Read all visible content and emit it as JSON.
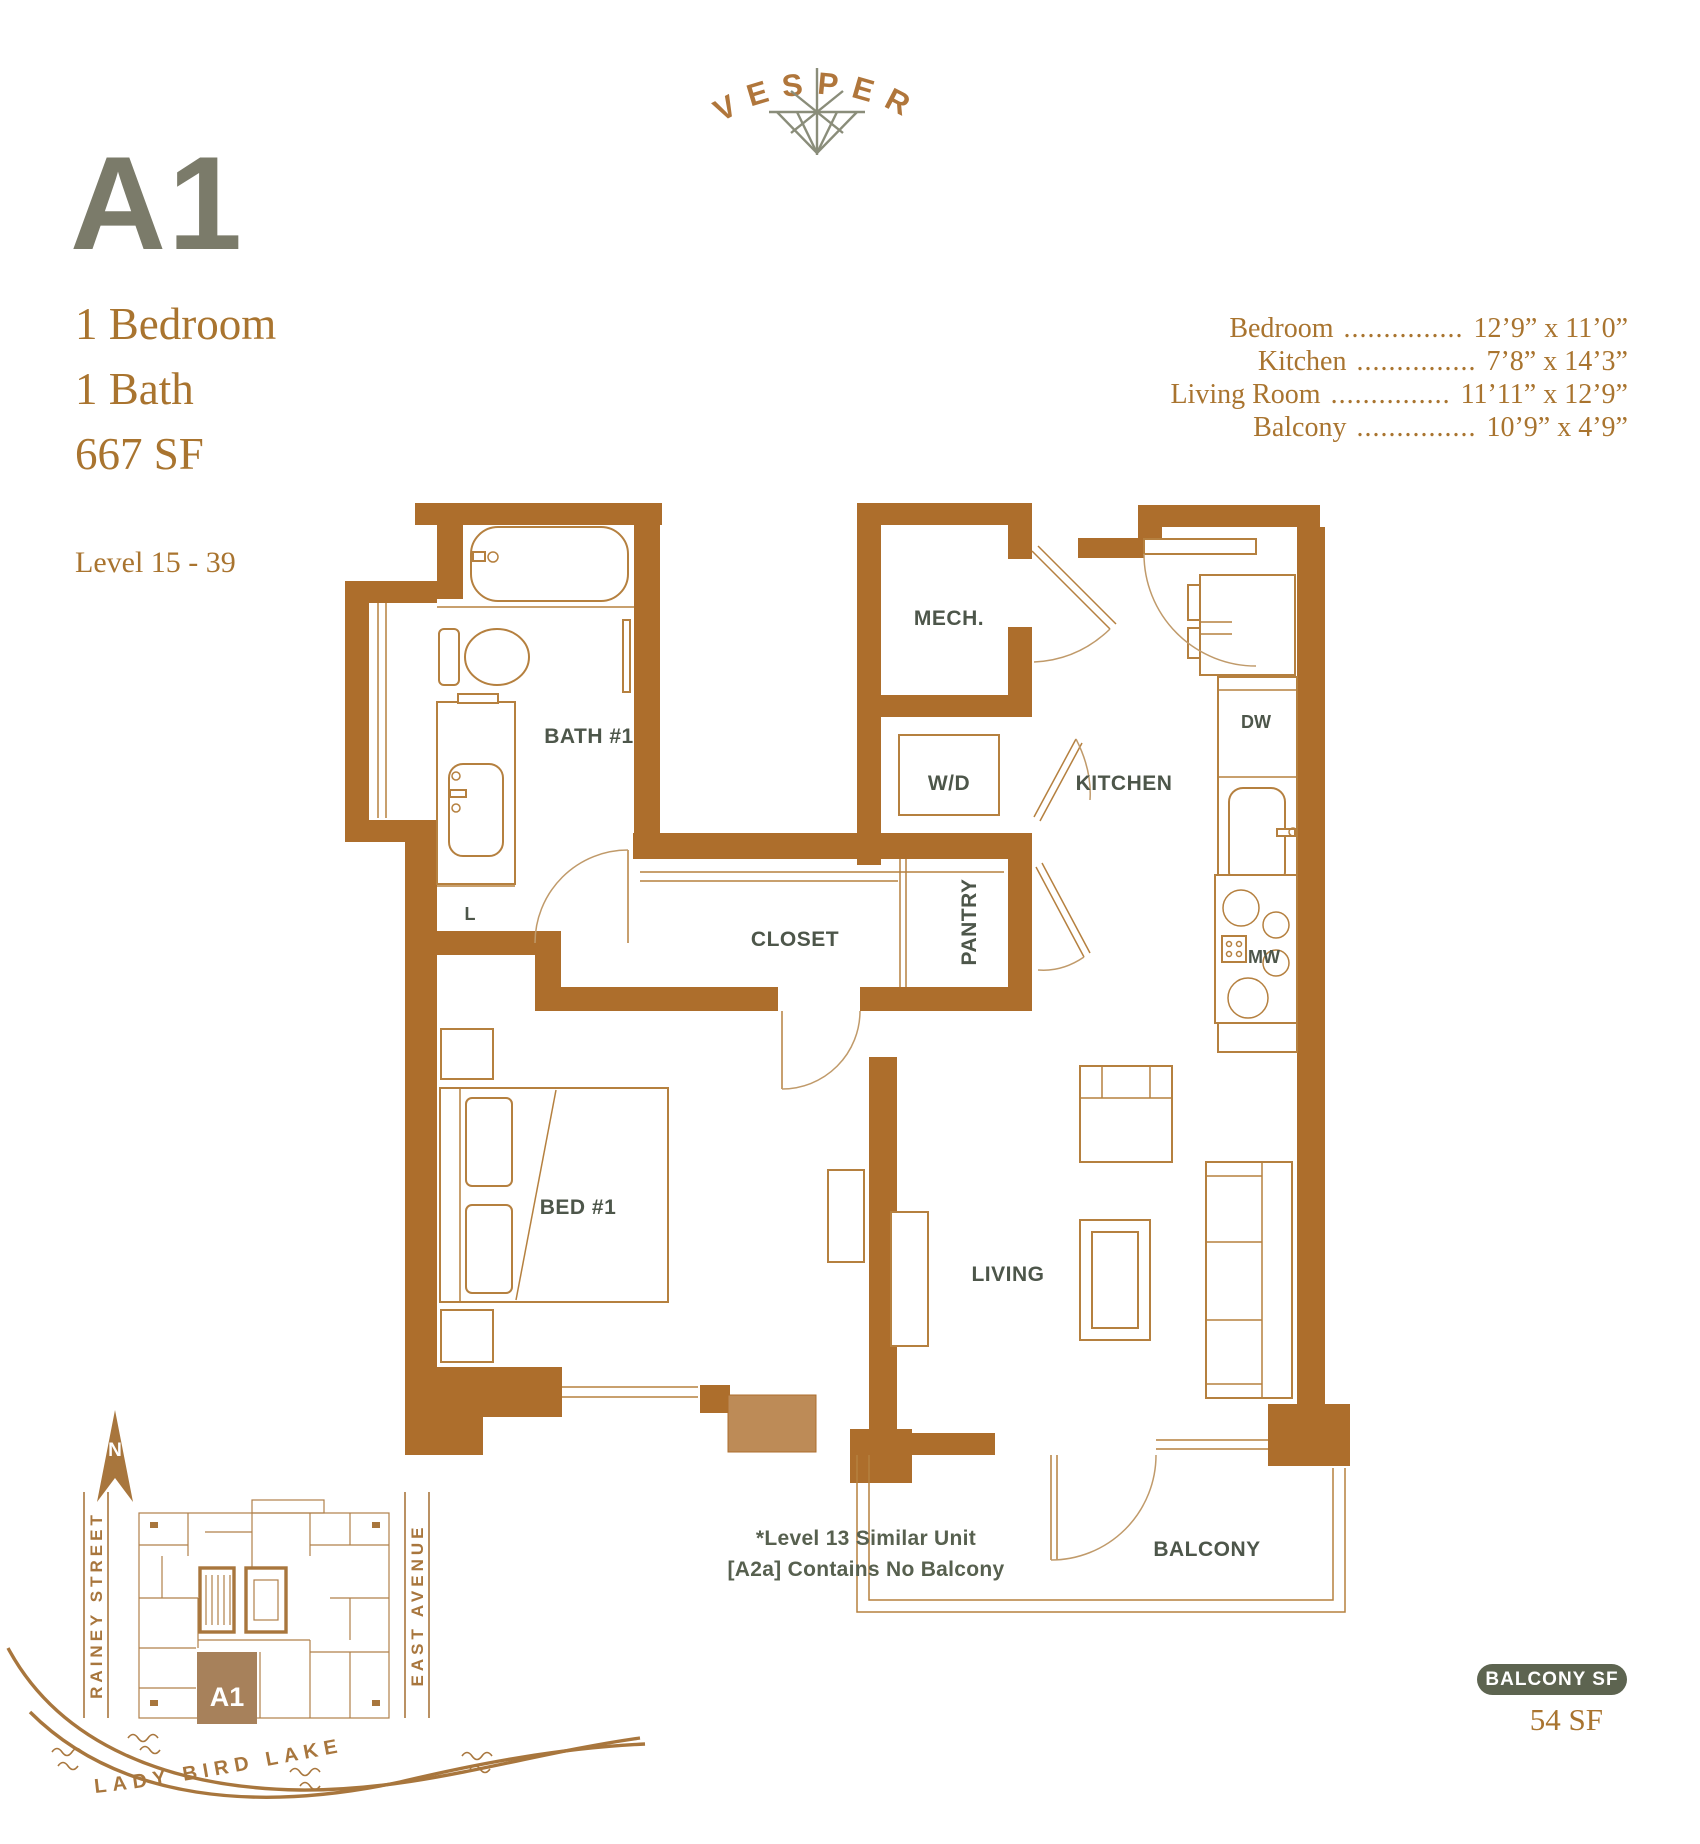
{
  "brand": {
    "name": "VESPER"
  },
  "unit": {
    "id": "A1",
    "bedrooms": "1 Bedroom",
    "baths": "1 Bath",
    "area": "667 SF",
    "levels": "Level 15 - 39"
  },
  "dimensions": {
    "rows": [
      {
        "label": "Bedroom",
        "dots": "...............",
        "value": "12’9” x 11’0”"
      },
      {
        "label": "Kitchen",
        "dots": "...............",
        "value": "7’8” x 14’3”"
      },
      {
        "label": "Living Room",
        "dots": "...............",
        "value": "11’11” x 12’9”"
      },
      {
        "label": "Balcony",
        "dots": "...............",
        "value": "10’9” x 4’9”"
      }
    ]
  },
  "plan": {
    "rooms": {
      "bath": "BATH #1",
      "mech": "MECH.",
      "wd": "W/D",
      "kitchen": "KITCHEN",
      "dw": "DW",
      "mw": "MW",
      "closet": "CLOSET",
      "pantry": "PANTRY",
      "linen": "L",
      "bed": "BED #1",
      "living": "LIVING",
      "balcony": "BALCONY"
    },
    "note_line1": "*Level 13 Similar Unit",
    "note_line2": "[A2a] Contains No Balcony"
  },
  "sitemap": {
    "north": "N",
    "street_left": "RAINEY STREET",
    "street_right": "EAST AVENUE",
    "lake": "LADY BIRD LAKE",
    "unit_marker": "A1"
  },
  "balcony_info": {
    "badge": "BALCONY SF",
    "value": "54 SF"
  },
  "colors": {
    "wall_brown": "#ad6e2c",
    "copper_text": "#a9742f",
    "unit_id_gray": "#7b7b6a",
    "label_olive": "#4d564a",
    "badge_olive": "#5d6450",
    "logo_star_sage": "#8a8d7a"
  }
}
